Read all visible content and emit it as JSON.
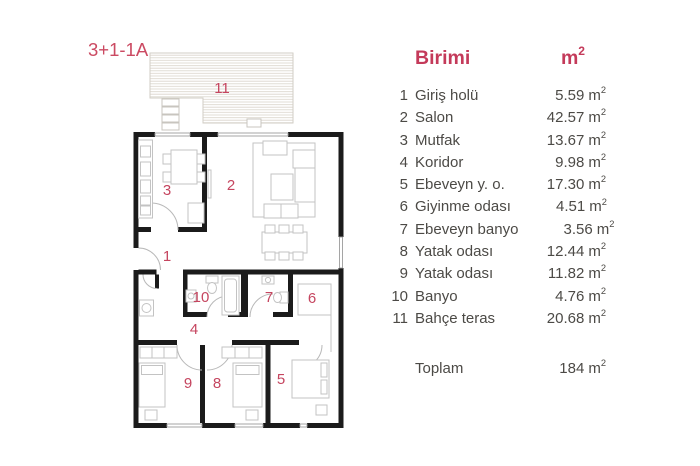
{
  "plan": {
    "title": "3+1-1A"
  },
  "table": {
    "header": {
      "unit_label": "Birimi"
    },
    "unit": {
      "base": "m",
      "exp": "2"
    },
    "rows": [
      {
        "no": "1",
        "name": "Giriş holü",
        "value": "5.59"
      },
      {
        "no": "2",
        "name": "Salon",
        "value": "42.57"
      },
      {
        "no": "3",
        "name": "Mutfak",
        "value": "13.67"
      },
      {
        "no": "4",
        "name": "Koridor",
        "value": "9.98"
      },
      {
        "no": "5",
        "name": "Ebeveyn y. o.",
        "value": "17.30"
      },
      {
        "no": "6",
        "name": "Giyinme odası",
        "value": "4.51"
      },
      {
        "no": "7",
        "name": "Ebeveyn banyo",
        "value": "3.56"
      },
      {
        "no": "8",
        "name": "Yatak odası",
        "value": "12.44"
      },
      {
        "no": "9",
        "name": "Yatak odası",
        "value": "11.82"
      },
      {
        "no": "10",
        "name": "Banyo",
        "value": "4.76"
      },
      {
        "no": "11",
        "name": "Bahçe teras",
        "value": "20.68"
      }
    ],
    "total": {
      "label": "Toplam",
      "value": "184"
    }
  },
  "colors": {
    "accent_red": "#c43a5a",
    "plan_label_red": "#c5455f",
    "wall_black": "#1b1b1b",
    "furniture_gray": "#c3c3c3",
    "terrace_line": "#ddd8d0",
    "text_gray": "#4c4a46",
    "background": "#ffffff"
  }
}
